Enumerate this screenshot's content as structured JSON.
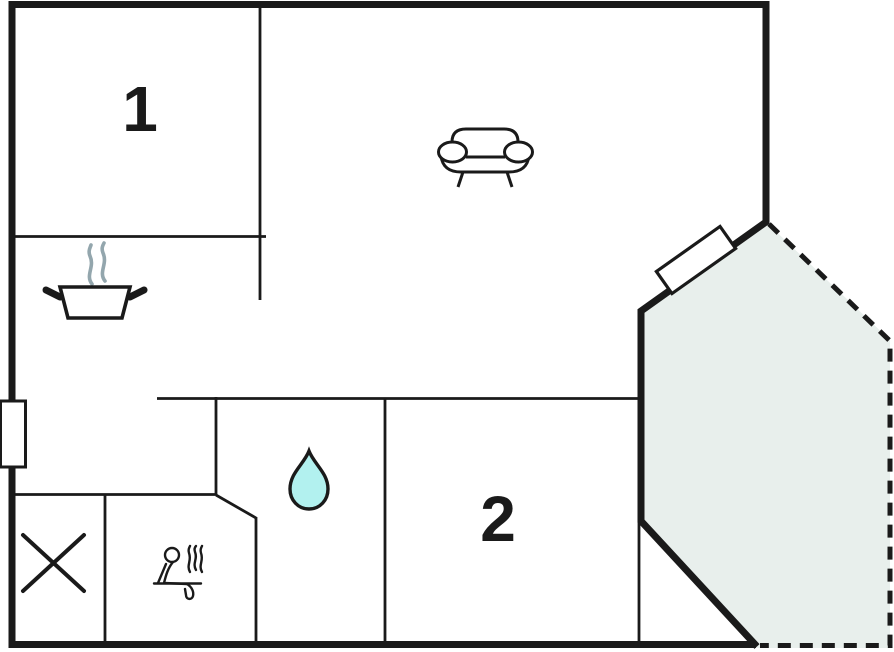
{
  "plan": {
    "room_labels": {
      "room1": "1",
      "room2": "2"
    },
    "icons": {
      "sofa": "sofa-icon",
      "cooking_pot": "cooking-pot-icon",
      "pot_steam": "steam-icon",
      "water_drop": "water-drop-icon",
      "sauna_person": "sauna-person-icon",
      "cross_mark": "cross-icon",
      "door": "door-icon",
      "window": "window-icon"
    },
    "colors": {
      "wall": "#1a1a1a",
      "terrace_fill": "#e8efec",
      "water_drop_fill": "#b2f1ef",
      "steam": "#93a6ad",
      "background": "#ffffff"
    }
  }
}
